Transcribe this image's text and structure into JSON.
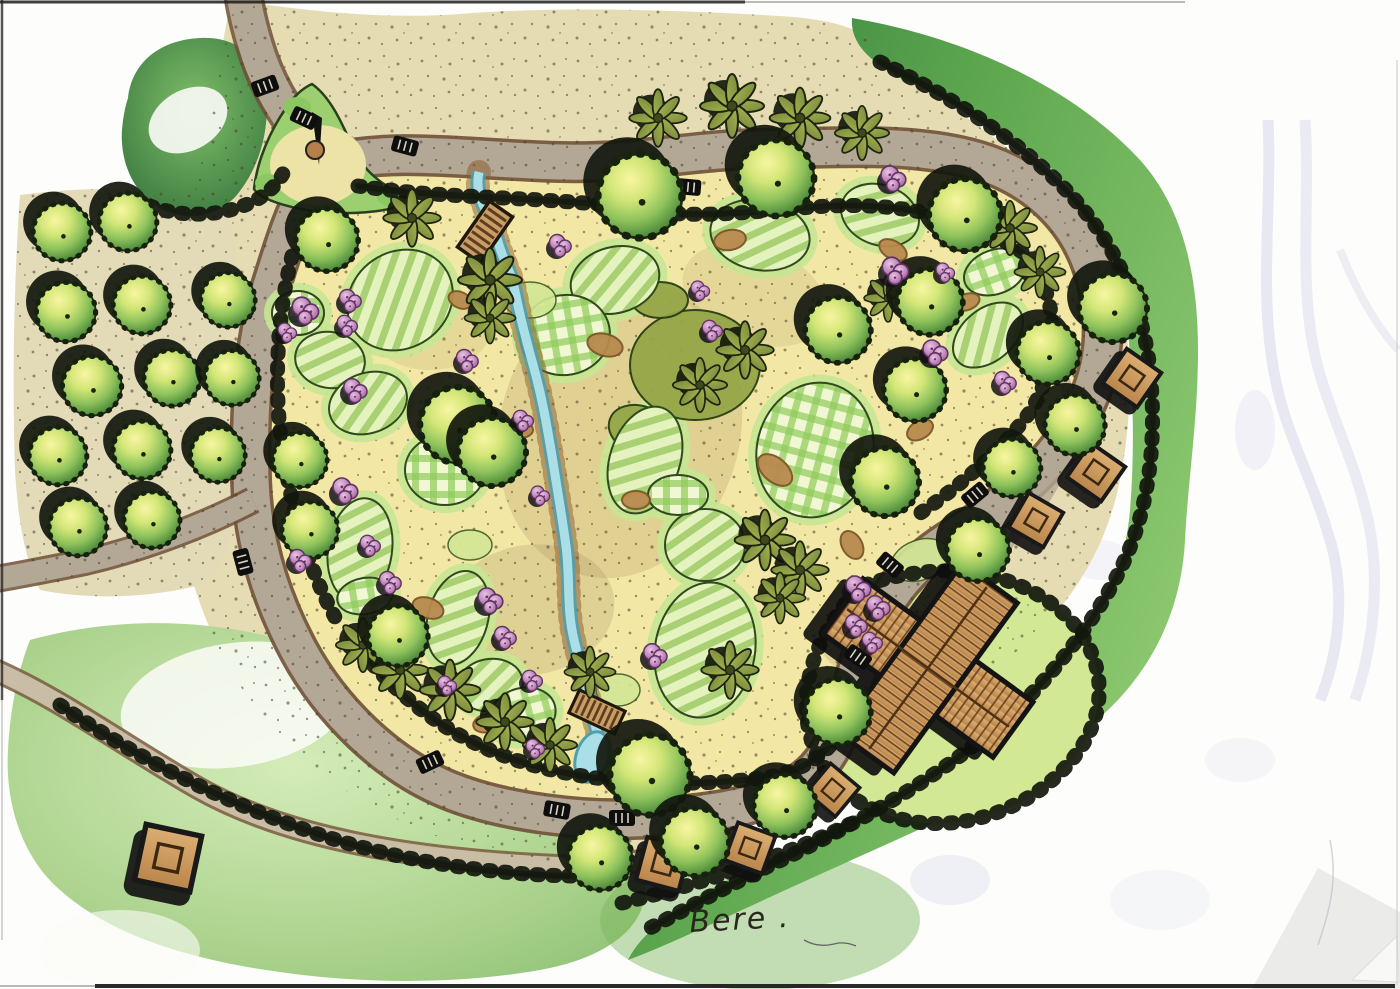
{
  "meta": {
    "signature": "Bere .",
    "drawing_type": "hand-drawn landscape masterplan"
  },
  "colors": {
    "paper": "#fdfdfb",
    "sand_inner": "#f2e7a4",
    "sand_outer": "#e6dcb4",
    "path_gray": "#b3a795",
    "path_casing": "#6e4f36",
    "trail": "#c9bda6",
    "water": "#aadfe7",
    "water_edge": "#4f9fae",
    "rock": "#8a5a2e",
    "ink": "#12170d",
    "bed_halo": "#c7e594",
    "olive_bed": "#95a648",
    "lawn": "#d2e895",
    "meadow": "#a9d18b",
    "mulch": "#b98a4e",
    "mulch_dark": "#7d5529",
    "roof_light": "#dcae72",
    "roof_dark": "#b9854b",
    "roof_line": "#6b421f",
    "ghost": "#c9c9e6",
    "fold": "#ebebe9",
    "signature_ink": "#2a251d"
  },
  "structures": {
    "building": {
      "transform": "translate(928,668) rotate(36)",
      "kind": "x-plan roofed building"
    },
    "plaza_feature": {
      "kind": "sundial-sculpture"
    }
  },
  "features": {
    "round_trees": [
      [
        640,
        196,
        1.05
      ],
      [
        776,
        178,
        0.95
      ],
      [
        965,
        215,
        0.9
      ],
      [
        930,
        302,
        0.82
      ],
      [
        838,
        330,
        0.82
      ],
      [
        915,
        390,
        0.78
      ],
      [
        885,
        482,
        0.85
      ],
      [
        978,
        550,
        0.78
      ],
      [
        1113,
        308,
        0.85
      ],
      [
        1048,
        353,
        0.78
      ],
      [
        1075,
        425,
        0.75
      ],
      [
        1012,
        468,
        0.72
      ],
      [
        327,
        240,
        0.78
      ],
      [
        300,
        460,
        0.68
      ],
      [
        310,
        530,
        0.7
      ],
      [
        398,
        636,
        0.75
      ],
      [
        458,
        425,
        0.95
      ],
      [
        492,
        452,
        0.85
      ],
      [
        650,
        775,
        1.0
      ],
      [
        600,
        858,
        0.8
      ],
      [
        695,
        842,
        0.85
      ],
      [
        785,
        806,
        0.78
      ],
      [
        838,
        712,
        0.82
      ]
    ],
    "orchard_trees": [
      [
        62,
        232,
        0.72
      ],
      [
        128,
        222,
        0.72
      ],
      [
        66,
        312,
        0.74
      ],
      [
        142,
        305,
        0.72
      ],
      [
        92,
        386,
        0.74
      ],
      [
        172,
        378,
        0.7
      ],
      [
        58,
        456,
        0.72
      ],
      [
        142,
        450,
        0.72
      ],
      [
        78,
        527,
        0.72
      ],
      [
        152,
        520,
        0.7
      ],
      [
        218,
        455,
        0.68
      ],
      [
        232,
        378,
        0.68
      ],
      [
        228,
        300,
        0.68
      ]
    ],
    "palm_trees": [
      [
        658,
        118,
        0.9
      ],
      [
        732,
        106,
        1.0
      ],
      [
        800,
        118,
        0.95
      ],
      [
        862,
        133,
        0.85
      ],
      [
        412,
        218,
        0.9
      ],
      [
        490,
        280,
        1.0
      ],
      [
        490,
        318,
        0.8
      ],
      [
        745,
        350,
        0.9
      ],
      [
        700,
        385,
        0.85
      ],
      [
        888,
        298,
        0.75
      ],
      [
        1010,
        228,
        0.85
      ],
      [
        1040,
        272,
        0.8
      ],
      [
        363,
        645,
        0.85
      ],
      [
        400,
        670,
        0.9
      ],
      [
        450,
        690,
        0.95
      ],
      [
        505,
        722,
        0.9
      ],
      [
        550,
        745,
        0.85
      ],
      [
        590,
        672,
        0.8
      ],
      [
        765,
        540,
        0.95
      ],
      [
        800,
        570,
        0.9
      ],
      [
        780,
        598,
        0.8
      ],
      [
        730,
        670,
        0.9
      ]
    ],
    "flower_shrubs": [
      [
        893,
        178,
        0.8
      ],
      [
        895,
        270,
        0.85
      ],
      [
        945,
        272,
        0.6
      ],
      [
        935,
        352,
        0.8
      ],
      [
        1005,
        382,
        0.7
      ],
      [
        305,
        310,
        0.85
      ],
      [
        350,
        300,
        0.7
      ],
      [
        347,
        325,
        0.65
      ],
      [
        287,
        332,
        0.6
      ],
      [
        355,
        390,
        0.75
      ],
      [
        345,
        490,
        0.8
      ],
      [
        300,
        560,
        0.7
      ],
      [
        370,
        545,
        0.65
      ],
      [
        390,
        582,
        0.7
      ],
      [
        490,
        600,
        0.8
      ],
      [
        505,
        637,
        0.7
      ],
      [
        532,
        680,
        0.65
      ],
      [
        447,
        685,
        0.6
      ],
      [
        535,
        748,
        0.6
      ],
      [
        655,
        655,
        0.75
      ],
      [
        467,
        360,
        0.7
      ],
      [
        523,
        420,
        0.65
      ],
      [
        540,
        495,
        0.6
      ],
      [
        858,
        588,
        0.8
      ],
      [
        878,
        607,
        0.75
      ],
      [
        856,
        625,
        0.7
      ],
      [
        872,
        642,
        0.65
      ],
      [
        560,
        245,
        0.7
      ],
      [
        700,
        290,
        0.6
      ],
      [
        712,
        330,
        0.65
      ]
    ],
    "pavilions": [
      [
        1132,
        378,
        1,
        35
      ],
      [
        1096,
        472,
        1,
        35
      ],
      [
        1036,
        520,
        0.95,
        30
      ],
      [
        833,
        790,
        0.9,
        40
      ],
      [
        663,
        864,
        1.05,
        15
      ],
      [
        750,
        848,
        0.95,
        20
      ],
      [
        168,
        858,
        1.35,
        12
      ]
    ],
    "benches": [
      [
        265,
        86,
        -20
      ],
      [
        405,
        146,
        15
      ],
      [
        688,
        187,
        5
      ],
      [
        245,
        303,
        85
      ],
      [
        243,
        562,
        75
      ],
      [
        304,
        118,
        25
      ],
      [
        430,
        762,
        -25
      ],
      [
        557,
        810,
        10
      ],
      [
        622,
        818,
        0
      ],
      [
        890,
        565,
        40
      ],
      [
        858,
        657,
        35
      ],
      [
        975,
        495,
        -40
      ]
    ],
    "bridges": [
      [
        485,
        232,
        1,
        -55
      ],
      [
        597,
        712,
        0.9,
        25
      ]
    ],
    "mulch": [
      [
        428,
        608,
        16,
        10,
        20
      ],
      [
        487,
        723,
        14,
        9,
        -15
      ],
      [
        893,
        250,
        15,
        9,
        30
      ],
      [
        967,
        302,
        13,
        8,
        -20
      ],
      [
        605,
        345,
        18,
        11,
        15
      ],
      [
        730,
        240,
        16,
        10,
        -10
      ],
      [
        775,
        470,
        20,
        12,
        40
      ],
      [
        852,
        545,
        15,
        10,
        60
      ],
      [
        520,
        430,
        13,
        8,
        0
      ],
      [
        460,
        300,
        12,
        8,
        25
      ],
      [
        636,
        500,
        14,
        9,
        0
      ],
      [
        920,
        430,
        14,
        9,
        -30
      ]
    ],
    "beds": {
      "striped": [
        [
          400,
          300,
          55,
          48,
          -35
        ],
        [
          330,
          360,
          35,
          28,
          10
        ],
        [
          368,
          403,
          40,
          30,
          -20
        ],
        [
          360,
          550,
          32,
          52,
          8
        ],
        [
          458,
          618,
          30,
          48,
          15
        ],
        [
          490,
          685,
          33,
          26,
          -10
        ],
        [
          615,
          280,
          45,
          33,
          -15
        ],
        [
          760,
          235,
          50,
          35,
          10
        ],
        [
          705,
          545,
          40,
          36,
          0
        ],
        [
          705,
          650,
          50,
          68,
          10
        ],
        [
          880,
          215,
          40,
          30,
          20
        ],
        [
          988,
          335,
          40,
          26,
          -40
        ],
        [
          645,
          460,
          35,
          55,
          18
        ]
      ],
      "gingham": [
        [
          298,
          313,
          26,
          22,
          0
        ],
        [
          565,
          335,
          45,
          40,
          -10
        ],
        [
          815,
          450,
          58,
          68,
          15
        ],
        [
          995,
          272,
          32,
          22,
          -20
        ],
        [
          678,
          495,
          30,
          20,
          0
        ],
        [
          523,
          714,
          33,
          26,
          -15
        ],
        [
          365,
          596,
          28,
          18,
          -10
        ],
        [
          445,
          470,
          40,
          35,
          0
        ]
      ],
      "olive": [
        [
          695,
          365,
          65,
          55,
          0
        ],
        [
          660,
          300,
          28,
          18,
          0
        ],
        [
          640,
          430,
          32,
          24,
          20
        ]
      ],
      "lawn_pads": [
        [
          530,
          300,
          26,
          18,
          0
        ],
        [
          470,
          545,
          22,
          15,
          0
        ],
        [
          618,
          690,
          22,
          16,
          0
        ],
        [
          920,
          560,
          30,
          20,
          -20
        ]
      ]
    }
  }
}
